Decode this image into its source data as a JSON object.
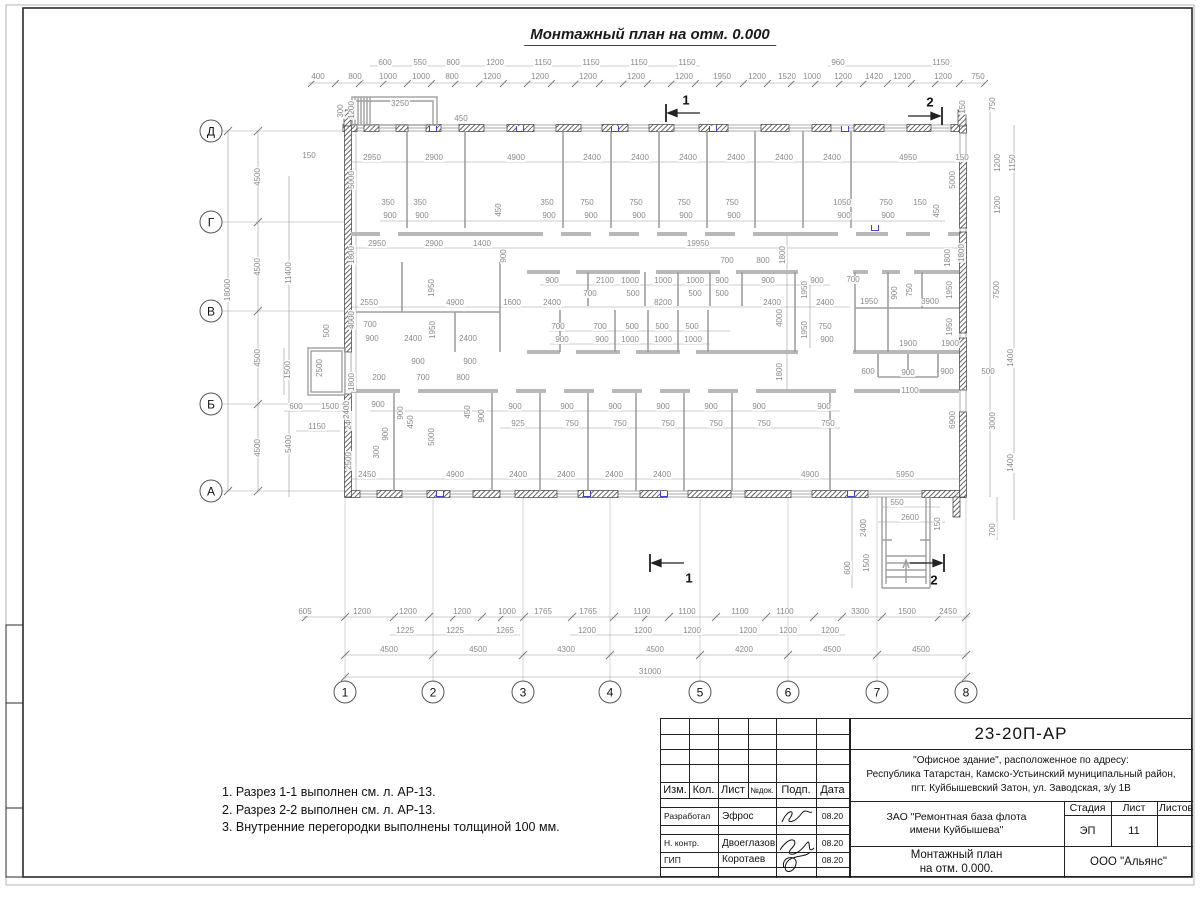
{
  "title": "Монтажный план на отм. 0.000",
  "notes": [
    "1. Разрез 1-1 выполнен см. л. АР-13.",
    "2. Разрез 2-2 выполнен см. л. АР-13.",
    "3. Внутренние перегородки выполнены толщиной 100 мм."
  ],
  "titleblock": {
    "doc_number": "23-20П-АР",
    "object_line1": "\"Офисное здание\", расположенное по адресу:",
    "object_line2": "Республика Татарстан, Камско-Устьинский муниципальный район,",
    "object_line3": "пгт. Куйбышевский Затон, ул. Заводская, з/у 1В",
    "client_line1": "ЗАО \"Ремонтная база флота",
    "client_line2": "имени Куйбышева\"",
    "drawing_line1": "Монтажный план",
    "drawing_line2": "на отм. 0.000.",
    "company": "ООО \"Альянс\"",
    "stage_label": "Стадия",
    "sheet_label": "Лист",
    "sheets_label": "Листов",
    "stage": "ЭП",
    "sheet_no": "11",
    "header_cols": [
      "Изм.",
      "Кол.",
      "Лист",
      "№док.",
      "Подп.",
      "Дата"
    ],
    "sign_rows": [
      {
        "role": "Разработал",
        "name": "Эфрос",
        "date": "08.20"
      },
      {
        "role": "Н. контр.",
        "name": "Двоеглазов",
        "date": "08.20"
      },
      {
        "role": "ГИП",
        "name": "Коротаев",
        "date": "08.20"
      }
    ]
  },
  "plan": {
    "axes": {
      "rows": [
        {
          "t": "Д",
          "x": 211,
          "y": 131
        },
        {
          "t": "Г",
          "x": 211,
          "y": 222
        },
        {
          "t": "В",
          "x": 211,
          "y": 311
        },
        {
          "t": "Б",
          "x": 211,
          "y": 404
        },
        {
          "t": "А",
          "x": 211,
          "y": 491
        }
      ],
      "cols": [
        {
          "t": "1",
          "x": 345,
          "y": 692
        },
        {
          "t": "2",
          "x": 433,
          "y": 692
        },
        {
          "t": "3",
          "x": 523,
          "y": 692
        },
        {
          "t": "4",
          "x": 610,
          "y": 692
        },
        {
          "t": "5",
          "x": 700,
          "y": 692
        },
        {
          "t": "6",
          "x": 788,
          "y": 692
        },
        {
          "t": "7",
          "x": 877,
          "y": 692
        },
        {
          "t": "8",
          "x": 966,
          "y": 692
        }
      ]
    },
    "section_labels": [
      [
        686,
        100,
        "1"
      ],
      [
        930,
        102,
        "2"
      ],
      [
        689,
        578,
        "1"
      ],
      [
        934,
        580,
        "2"
      ]
    ],
    "panel_marks": [
      [
        433,
        129
      ],
      [
        520,
        129
      ],
      [
        615,
        129
      ],
      [
        713,
        129
      ],
      [
        845,
        129
      ],
      [
        440,
        494
      ],
      [
        587,
        494
      ],
      [
        664,
        494
      ],
      [
        851,
        494
      ],
      [
        875,
        228
      ]
    ],
    "dims": [
      [
        385,
        63,
        "600"
      ],
      [
        420,
        63,
        "550"
      ],
      [
        453,
        63,
        "800"
      ],
      [
        495,
        63,
        "1200"
      ],
      [
        543,
        63,
        "1150"
      ],
      [
        591,
        63,
        "1150"
      ],
      [
        639,
        63,
        "1150"
      ],
      [
        687,
        63,
        "1150"
      ],
      [
        838,
        63,
        "960"
      ],
      [
        941,
        63,
        "1150"
      ],
      [
        318,
        77,
        "400"
      ],
      [
        355,
        77,
        "800"
      ],
      [
        388,
        77,
        "1000"
      ],
      [
        421,
        77,
        "1000"
      ],
      [
        452,
        77,
        "800"
      ],
      [
        492,
        77,
        "1200"
      ],
      [
        540,
        77,
        "1200"
      ],
      [
        588,
        77,
        "1200"
      ],
      [
        636,
        77,
        "1200"
      ],
      [
        684,
        77,
        "1200"
      ],
      [
        722,
        77,
        "1950"
      ],
      [
        757,
        77,
        "1200"
      ],
      [
        787,
        77,
        "1520"
      ],
      [
        812,
        77,
        "1000"
      ],
      [
        843,
        77,
        "1200"
      ],
      [
        874,
        77,
        "1420"
      ],
      [
        902,
        77,
        "1200"
      ],
      [
        943,
        77,
        "1200"
      ],
      [
        978,
        77,
        "750"
      ],
      [
        341,
        111,
        "300",
        "v"
      ],
      [
        352,
        110,
        "1200",
        "v"
      ],
      [
        400,
        104,
        "3250"
      ],
      [
        461,
        119,
        "450"
      ],
      [
        963,
        107,
        "150",
        "v"
      ],
      [
        993,
        104,
        "750",
        "v"
      ],
      [
        228,
        290,
        "18000",
        "v"
      ],
      [
        258,
        177,
        "4500",
        "v"
      ],
      [
        258,
        267,
        "4500",
        "v"
      ],
      [
        258,
        358,
        "4500",
        "v"
      ],
      [
        258,
        448,
        "4500",
        "v"
      ],
      [
        289,
        273,
        "11400",
        "v"
      ],
      [
        289,
        444,
        "5400",
        "v"
      ],
      [
        352,
        180,
        "5000",
        "v"
      ],
      [
        352,
        255,
        "1800",
        "v"
      ],
      [
        352,
        320,
        "4000",
        "v"
      ],
      [
        352,
        382,
        "1800",
        "v"
      ],
      [
        349,
        421,
        "2400",
        "v"
      ],
      [
        349,
        461,
        "2500",
        "v"
      ],
      [
        288,
        370,
        "1500",
        "v"
      ],
      [
        320,
        368,
        "2500",
        "v"
      ],
      [
        327,
        331,
        "500",
        "v"
      ],
      [
        296,
        407,
        "600"
      ],
      [
        330,
        407,
        "1500"
      ],
      [
        317,
        427,
        "1150"
      ],
      [
        953,
        180,
        "5000",
        "v"
      ],
      [
        962,
        253,
        "1800",
        "v"
      ],
      [
        998,
        163,
        "1200",
        "v"
      ],
      [
        1013,
        163,
        "1150",
        "v"
      ],
      [
        998,
        205,
        "1200",
        "v"
      ],
      [
        997,
        290,
        "7500",
        "v"
      ],
      [
        1011,
        358,
        "1400",
        "v"
      ],
      [
        988,
        372,
        "500"
      ],
      [
        993,
        421,
        "3000",
        "v"
      ],
      [
        1011,
        463,
        "1400",
        "v"
      ],
      [
        953,
        420,
        "6900",
        "v"
      ],
      [
        948,
        258,
        "1800",
        "v"
      ],
      [
        950,
        290,
        "1950",
        "v"
      ],
      [
        950,
        327,
        "1950",
        "v"
      ],
      [
        908,
        344,
        "1900"
      ],
      [
        950,
        344,
        "1900"
      ],
      [
        868,
        372,
        "600"
      ],
      [
        908,
        373,
        "900"
      ],
      [
        947,
        372,
        "900"
      ],
      [
        910,
        391,
        "1100"
      ],
      [
        869,
        302,
        "1950"
      ],
      [
        895,
        293,
        "900",
        "v"
      ],
      [
        910,
        290,
        "750",
        "v"
      ],
      [
        930,
        302,
        "3900"
      ],
      [
        853,
        280,
        "700"
      ],
      [
        962,
        158,
        "150"
      ],
      [
        309,
        156,
        "150"
      ],
      [
        372,
        158,
        "2950"
      ],
      [
        434,
        158,
        "2900"
      ],
      [
        516,
        158,
        "4900"
      ],
      [
        592,
        158,
        "2400"
      ],
      [
        640,
        158,
        "2400"
      ],
      [
        688,
        158,
        "2400"
      ],
      [
        736,
        158,
        "2400"
      ],
      [
        784,
        158,
        "2400"
      ],
      [
        832,
        158,
        "2400"
      ],
      [
        908,
        158,
        "4950"
      ],
      [
        388,
        203,
        "350"
      ],
      [
        420,
        203,
        "350"
      ],
      [
        390,
        216,
        "900"
      ],
      [
        422,
        216,
        "900"
      ],
      [
        499,
        210,
        "450",
        "v"
      ],
      [
        547,
        203,
        "350"
      ],
      [
        587,
        203,
        "750"
      ],
      [
        636,
        203,
        "750"
      ],
      [
        684,
        203,
        "750"
      ],
      [
        732,
        203,
        "750"
      ],
      [
        549,
        216,
        "900"
      ],
      [
        591,
        216,
        "900"
      ],
      [
        639,
        216,
        "900"
      ],
      [
        686,
        216,
        "900"
      ],
      [
        734,
        216,
        "900"
      ],
      [
        842,
        203,
        "1050"
      ],
      [
        844,
        216,
        "900"
      ],
      [
        886,
        203,
        "750"
      ],
      [
        888,
        216,
        "900"
      ],
      [
        920,
        203,
        "150"
      ],
      [
        937,
        211,
        "450",
        "v"
      ],
      [
        377,
        244,
        "2950"
      ],
      [
        434,
        244,
        "2900"
      ],
      [
        482,
        244,
        "1400"
      ],
      [
        698,
        244,
        "19950"
      ],
      [
        504,
        256,
        "900",
        "v"
      ],
      [
        727,
        261,
        "700"
      ],
      [
        763,
        261,
        "800"
      ],
      [
        783,
        255,
        "1800",
        "v"
      ],
      [
        552,
        281,
        "900"
      ],
      [
        605,
        281,
        "2100"
      ],
      [
        630,
        281,
        "1000"
      ],
      [
        663,
        281,
        "1000"
      ],
      [
        695,
        281,
        "1000"
      ],
      [
        722,
        281,
        "900"
      ],
      [
        768,
        281,
        "900"
      ],
      [
        817,
        281,
        "900"
      ],
      [
        590,
        294,
        "700"
      ],
      [
        633,
        294,
        "500"
      ],
      [
        695,
        294,
        "500"
      ],
      [
        722,
        294,
        "500"
      ],
      [
        552,
        303,
        "2400"
      ],
      [
        663,
        303,
        "8200"
      ],
      [
        772,
        303,
        "2400"
      ],
      [
        825,
        303,
        "2400"
      ],
      [
        558,
        327,
        "700"
      ],
      [
        600,
        327,
        "700"
      ],
      [
        632,
        327,
        "500"
      ],
      [
        662,
        327,
        "500"
      ],
      [
        692,
        327,
        "500"
      ],
      [
        825,
        327,
        "750"
      ],
      [
        562,
        340,
        "900"
      ],
      [
        602,
        340,
        "900"
      ],
      [
        630,
        340,
        "1000"
      ],
      [
        663,
        340,
        "1000"
      ],
      [
        693,
        340,
        "1000"
      ],
      [
        827,
        340,
        "900"
      ],
      [
        780,
        318,
        "4000",
        "v"
      ],
      [
        780,
        372,
        "1800",
        "v"
      ],
      [
        805,
        290,
        "1950",
        "v"
      ],
      [
        805,
        330,
        "1950",
        "v"
      ],
      [
        369,
        303,
        "2550"
      ],
      [
        455,
        303,
        "4900"
      ],
      [
        512,
        303,
        "1600"
      ],
      [
        432,
        288,
        "1950",
        "v"
      ],
      [
        433,
        330,
        "1950",
        "v"
      ],
      [
        370,
        325,
        "700"
      ],
      [
        372,
        339,
        "900"
      ],
      [
        413,
        339,
        "2400"
      ],
      [
        468,
        339,
        "2400"
      ],
      [
        418,
        362,
        "900"
      ],
      [
        470,
        362,
        "900"
      ],
      [
        379,
        378,
        "200"
      ],
      [
        423,
        378,
        "700"
      ],
      [
        463,
        378,
        "800"
      ],
      [
        378,
        405,
        "900"
      ],
      [
        347,
        410,
        "2400",
        "v"
      ],
      [
        401,
        413,
        "900",
        "v"
      ],
      [
        411,
        422,
        "450",
        "v"
      ],
      [
        468,
        412,
        "450",
        "v"
      ],
      [
        482,
        416,
        "900",
        "v"
      ],
      [
        432,
        437,
        "5000",
        "v"
      ],
      [
        377,
        452,
        "300",
        "v"
      ],
      [
        386,
        434,
        "900",
        "v"
      ],
      [
        515,
        407,
        "900"
      ],
      [
        518,
        424,
        "925"
      ],
      [
        567,
        407,
        "900"
      ],
      [
        572,
        424,
        "750"
      ],
      [
        615,
        407,
        "900"
      ],
      [
        620,
        424,
        "750"
      ],
      [
        663,
        407,
        "900"
      ],
      [
        668,
        424,
        "750"
      ],
      [
        711,
        407,
        "900"
      ],
      [
        716,
        424,
        "750"
      ],
      [
        759,
        407,
        "900"
      ],
      [
        764,
        424,
        "750"
      ],
      [
        824,
        407,
        "900"
      ],
      [
        828,
        424,
        "750"
      ],
      [
        367,
        475,
        "2450"
      ],
      [
        455,
        475,
        "4900"
      ],
      [
        518,
        475,
        "2400"
      ],
      [
        566,
        475,
        "2400"
      ],
      [
        614,
        475,
        "2400"
      ],
      [
        662,
        475,
        "2400"
      ],
      [
        810,
        475,
        "4900"
      ],
      [
        905,
        475,
        "5950"
      ],
      [
        897,
        503,
        "550"
      ],
      [
        910,
        518,
        "2600"
      ],
      [
        938,
        524,
        "150",
        "v"
      ],
      [
        864,
        528,
        "2400",
        "v"
      ],
      [
        867,
        563,
        "1500",
        "v"
      ],
      [
        848,
        568,
        "600",
        "v"
      ],
      [
        993,
        530,
        "700",
        "v"
      ],
      [
        305,
        612,
        "605"
      ],
      [
        362,
        612,
        "1200"
      ],
      [
        408,
        612,
        "1200"
      ],
      [
        462,
        612,
        "1200"
      ],
      [
        507,
        612,
        "1000"
      ],
      [
        543,
        612,
        "1765"
      ],
      [
        588,
        612,
        "1765"
      ],
      [
        642,
        612,
        "1100"
      ],
      [
        687,
        612,
        "1100"
      ],
      [
        740,
        612,
        "1100"
      ],
      [
        785,
        612,
        "1100"
      ],
      [
        860,
        612,
        "3300"
      ],
      [
        907,
        612,
        "1500"
      ],
      [
        948,
        612,
        "2450"
      ],
      [
        405,
        631,
        "1225"
      ],
      [
        455,
        631,
        "1225"
      ],
      [
        505,
        631,
        "1265"
      ],
      [
        587,
        631,
        "1200"
      ],
      [
        643,
        631,
        "1200"
      ],
      [
        692,
        631,
        "1200"
      ],
      [
        748,
        631,
        "1200"
      ],
      [
        788,
        631,
        "1200"
      ],
      [
        830,
        631,
        "1200"
      ],
      [
        389,
        650,
        "4500"
      ],
      [
        478,
        650,
        "4500"
      ],
      [
        566,
        650,
        "4300"
      ],
      [
        655,
        650,
        "4500"
      ],
      [
        744,
        650,
        "4200"
      ],
      [
        832,
        650,
        "4500"
      ],
      [
        921,
        650,
        "4500"
      ],
      [
        650,
        672,
        "31000"
      ]
    ]
  }
}
